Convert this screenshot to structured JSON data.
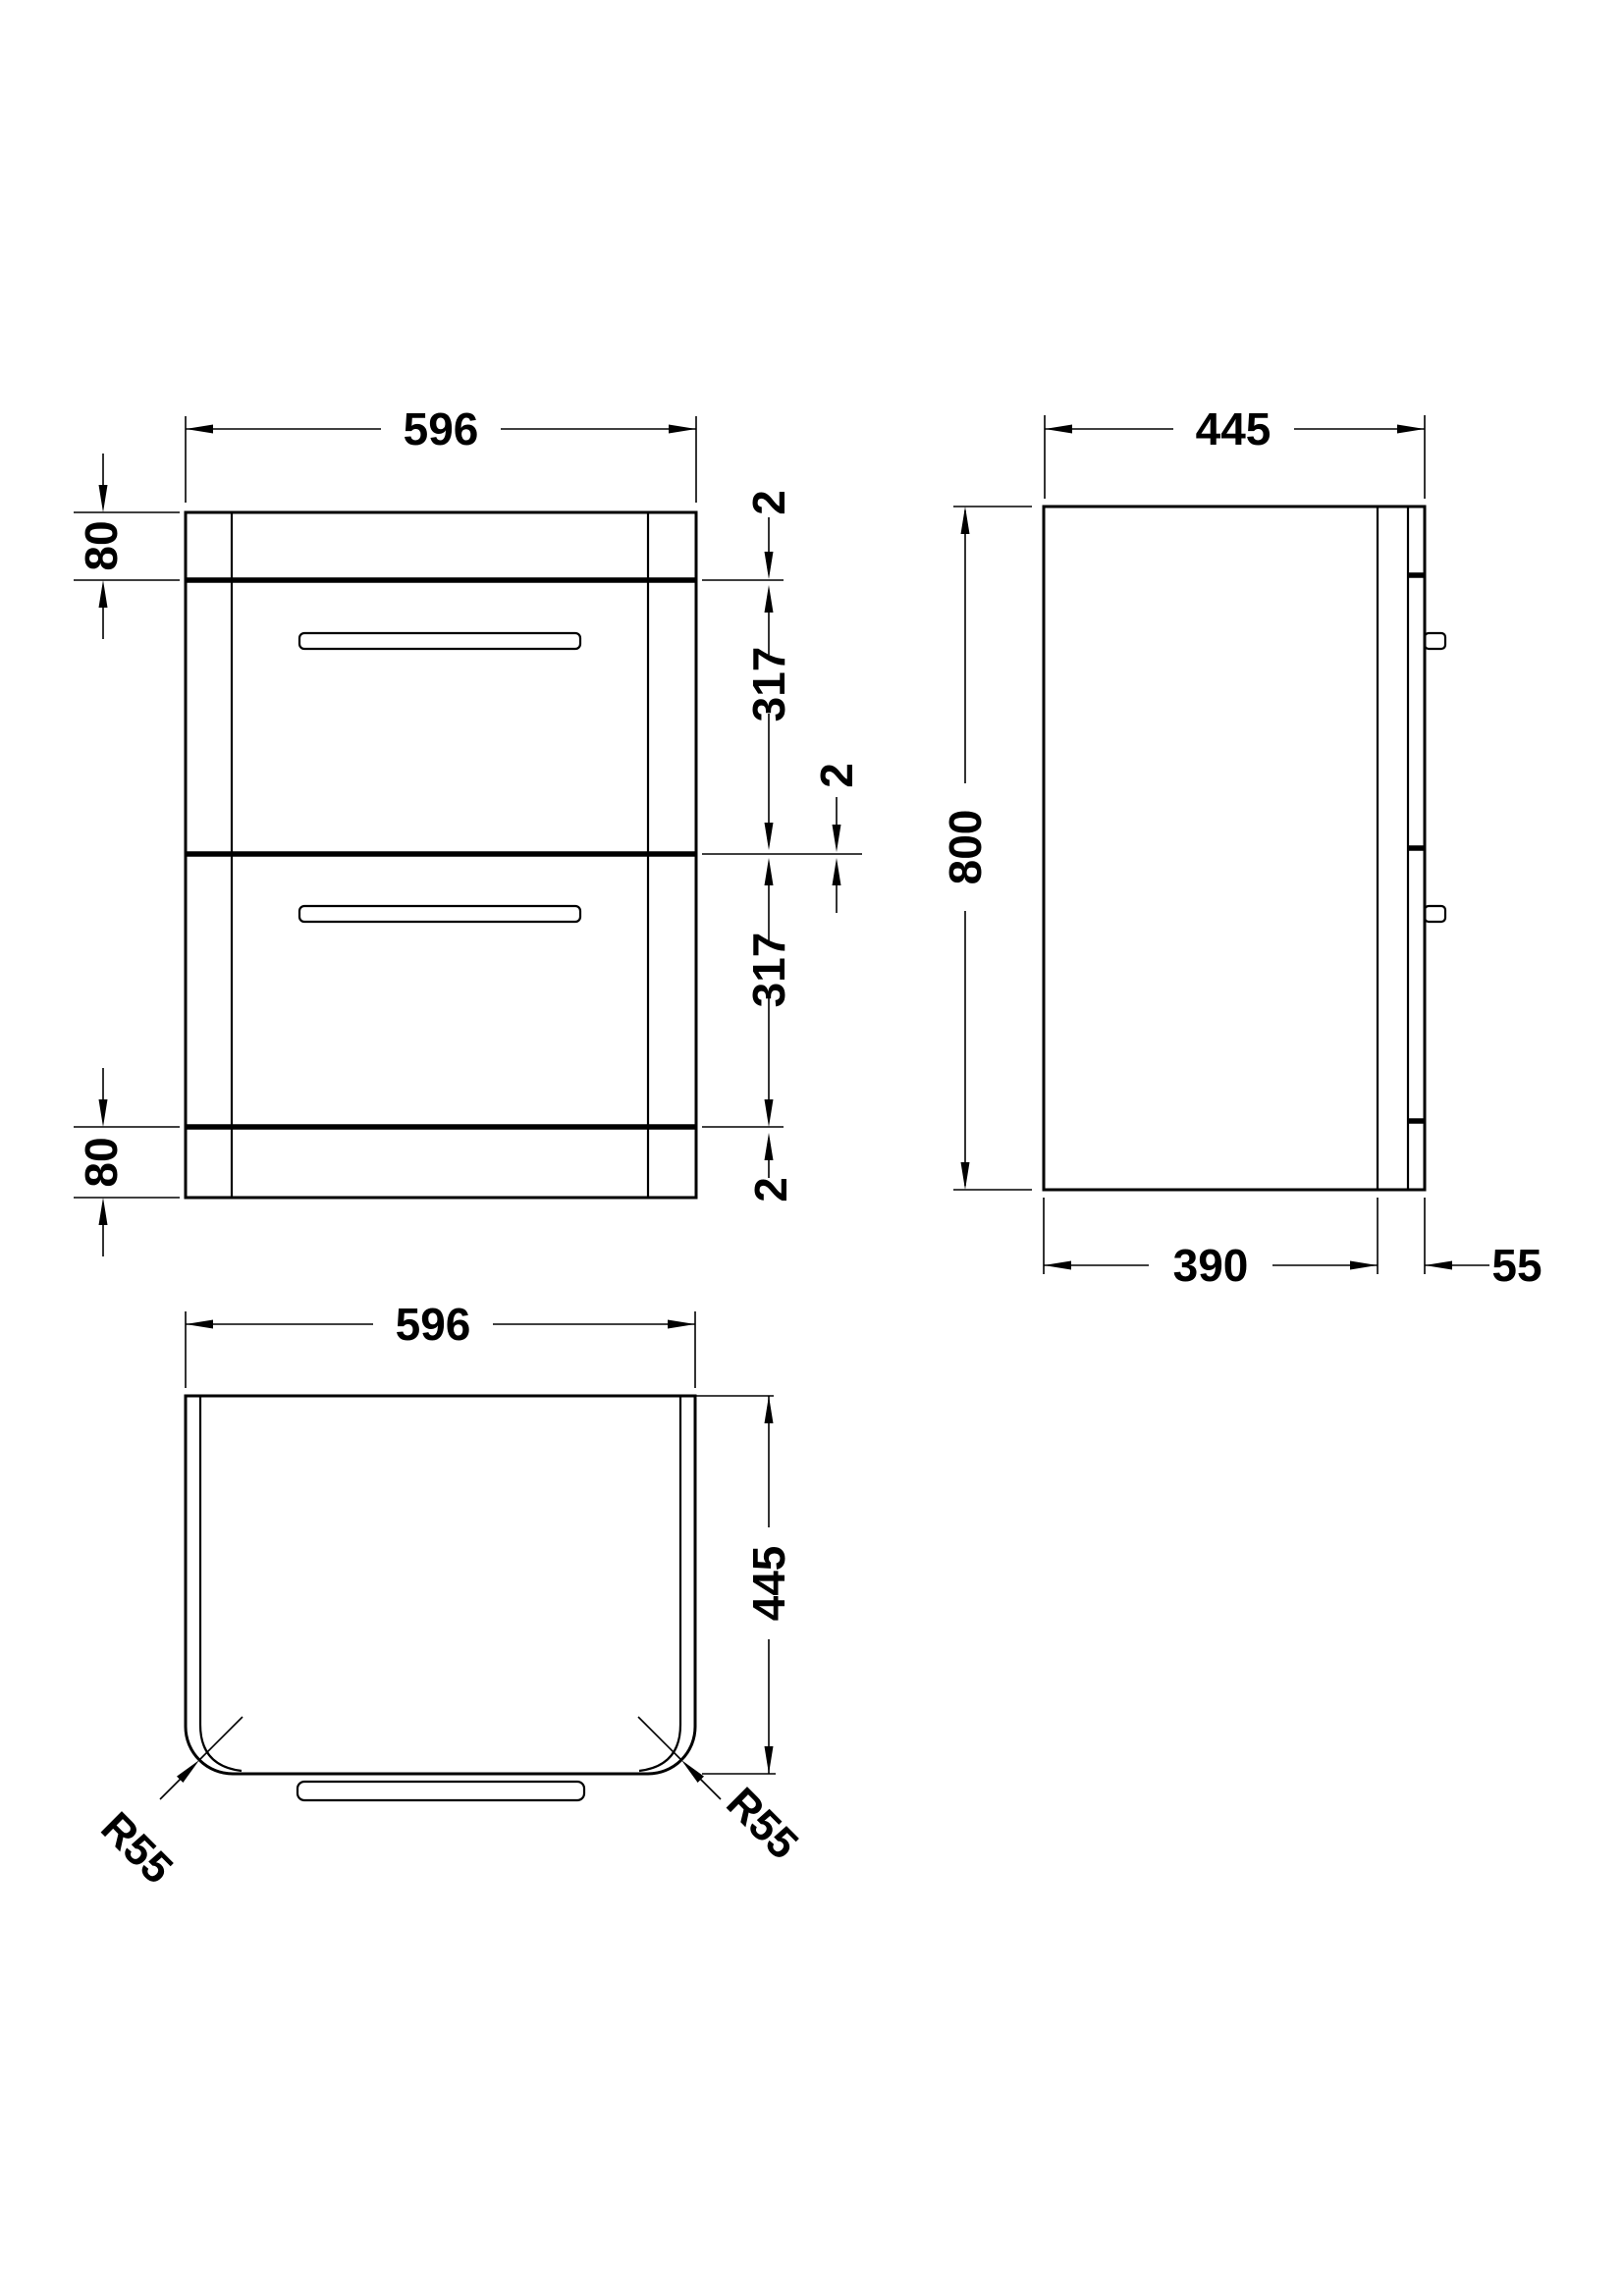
{
  "meta": {
    "drawing_type": "furniture technical drawing - two drawer vanity unit",
    "unit": "mm",
    "background_color": "#ffffff",
    "line_color": "#000000"
  },
  "front": {
    "width": "596",
    "top_rail_height": "80",
    "gap_top": "2",
    "drawer1_height": "317",
    "gap_middle": "2",
    "drawer2_height": "317",
    "gap_bottom": "2",
    "bottom_rail_height": "80"
  },
  "side": {
    "depth": "445",
    "height": "800",
    "carcass_depth": "390",
    "front_projection": "55"
  },
  "plan": {
    "width": "596",
    "depth": "445",
    "corner_radius_left": "R55",
    "corner_radius_right": "R55"
  }
}
